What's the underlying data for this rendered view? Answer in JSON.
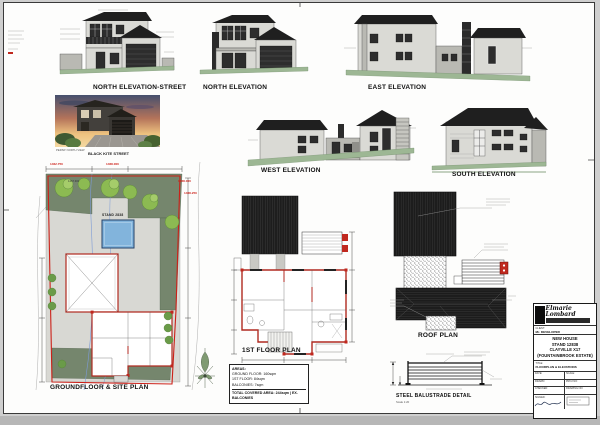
{
  "sheet_title": "Architectural drawing sheet",
  "elevations": [
    {
      "label": "NORTH ELEVATION-STREET"
    },
    {
      "label": "NORTH ELEVATION"
    },
    {
      "label": "EAST ELEVATION"
    },
    {
      "label": "WEST ELEVATION"
    },
    {
      "label": "SOUTH ELEVATION"
    }
  ],
  "photo": {
    "caption": "PERSP. NORTH VIEW"
  },
  "site_plan": {
    "street_label": "BLACK KITE STREET",
    "stand_label": "STAND 2838",
    "title": "GROUNDFLOOR & SITE PLAN",
    "levels": [
      "1462.750",
      "1468.000",
      "1468.000",
      "1468.250",
      "1467.300"
    ]
  },
  "first_floor": {
    "title": "1ST FLOOR PLAN"
  },
  "roof_plan": {
    "title": "ROOF PLAN"
  },
  "balustrade": {
    "title": "STEEL BALUSTRADE DETAIL",
    "scale": "Scale 1:20"
  },
  "areas_box": {
    "heading": "AREAS:",
    "lines": [
      "GROUND FLOOR: 160sqm",
      "1ST FLOOR: 84sqm",
      "BALCONIES: 7sqm"
    ],
    "total": "TOTAL COVERED AREA: 244sqm | EX. BALCONIES"
  },
  "title_block": {
    "logo_text": "Elmarie Lombard",
    "client_label": "CLIENT:",
    "client": "Mr. DEVELOPER",
    "project_label": "PROJECT:",
    "project_lines": [
      "NEW HOUSE",
      "STAND 12838",
      "CLAYVILLE X17",
      "(FOUNTAINBROOK ESTATE)"
    ],
    "title_label": "TITLE:",
    "title": "FLOORPLAN & ELEVATIONS",
    "fields": [
      {
        "label": "DATE:",
        "value": ""
      },
      {
        "label": "SCALE:",
        "value": ""
      },
      {
        "label": "DRAWN:",
        "value": ""
      },
      {
        "label": "PROJ NO:",
        "value": ""
      },
      {
        "label": "CHECKED:",
        "value": ""
      },
      {
        "label": "DRAWING NO:",
        "value": ""
      }
    ],
    "signed_label": "SIGNED:"
  },
  "colors": {
    "roof": "#1f1f1f",
    "wall": "#dadad5",
    "ground_green": "#9db794",
    "garden_green": "#75866d",
    "tree_green": "#8cba52",
    "pool_blue": "#82b4dc",
    "boundary_red": "#cc2018",
    "wall_red": "#b02a20"
  }
}
